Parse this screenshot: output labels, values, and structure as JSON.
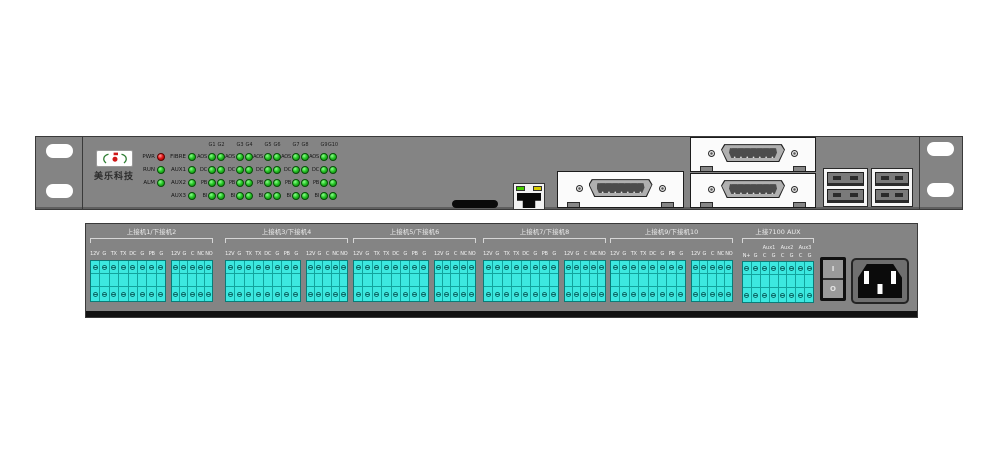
{
  "brand": {
    "logo_text": "美乐科技"
  },
  "front_panel": {
    "status_leds": [
      {
        "label": "PWR",
        "color": "red"
      },
      {
        "label": "RUN",
        "color": "green"
      },
      {
        "label": "ALM",
        "color": "green"
      }
    ],
    "aux_leds": [
      {
        "label": "FIBRE",
        "color": "green"
      },
      {
        "label": "AUX1",
        "color": "green"
      },
      {
        "label": "AUX2",
        "color": "green"
      },
      {
        "label": "AUX3",
        "color": "green"
      }
    ],
    "channel_headers": [
      "G1",
      "G2",
      "G3",
      "G4",
      "G5",
      "G6",
      "G7",
      "G8",
      "G9",
      "G10"
    ],
    "row_labels": [
      "AOS",
      "DC",
      "PB",
      "BI"
    ],
    "group_count": 5
  },
  "rear_panel": {
    "groups": [
      {
        "label": "上接机1/下接机2"
      },
      {
        "label": "上接机3/下接机4"
      },
      {
        "label": "上接机5/下接机6"
      },
      {
        "label": "上接机7/下接机8"
      },
      {
        "label": "上接机9/下接机10"
      }
    ],
    "block1_terminals": [
      "12V",
      "G",
      "TX",
      "TX",
      "DC",
      "G",
      "PB",
      "G"
    ],
    "block2_terminals": [
      "12V",
      "G",
      "C",
      "NC",
      "NO"
    ],
    "aux": {
      "label": "上接7100 AUX",
      "sub_labels": [
        "Aux1",
        "Aux2",
        "Aux3"
      ],
      "terminals": [
        "N+",
        "G",
        "C",
        "G",
        "C",
        "G",
        "C",
        "G"
      ]
    },
    "power_switch": {
      "on": "I",
      "off": "O"
    }
  },
  "colors": {
    "panel": "#848484",
    "terminal_block": "#3ce8e0",
    "led_green": "#24c324",
    "led_red": "#e01212"
  }
}
